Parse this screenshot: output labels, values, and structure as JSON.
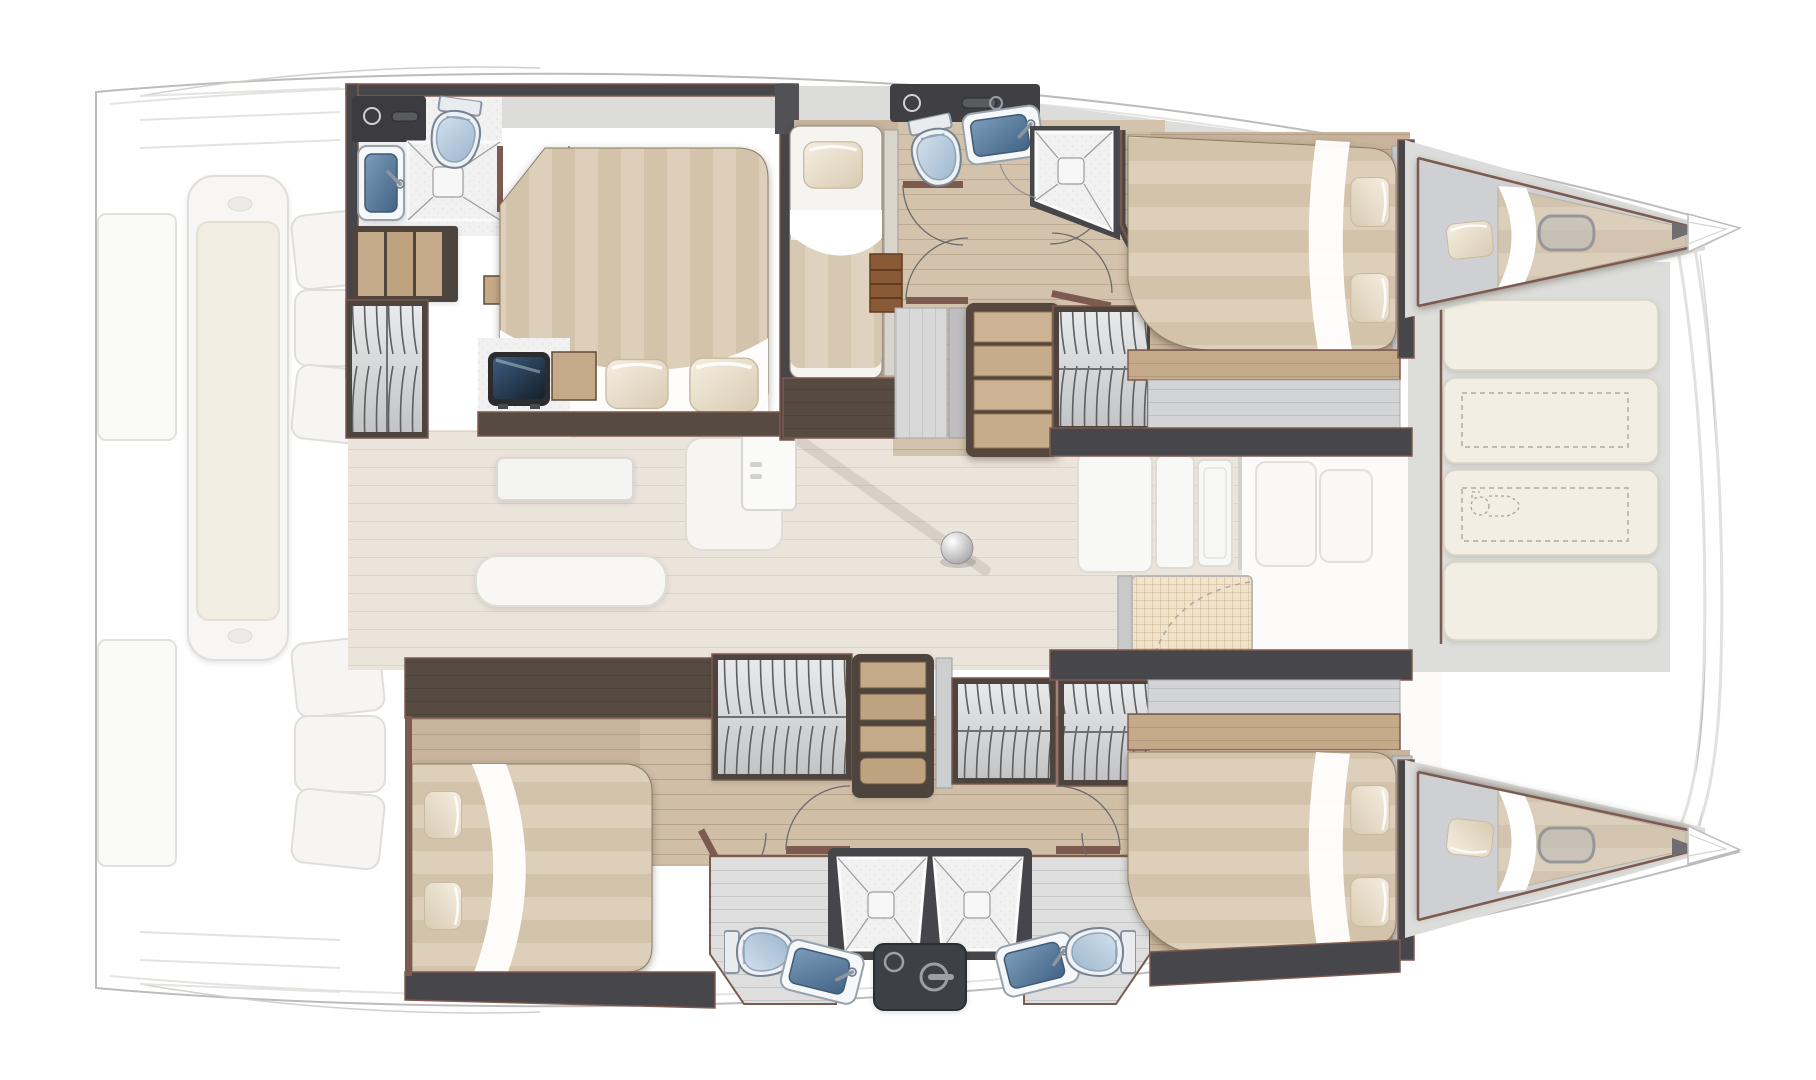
{
  "document": {
    "kind": "catamaran-interior-floor-plan",
    "view": "top-down",
    "orientation": "bow-right-stern-left",
    "canvas_px": {
      "w": 1816,
      "h": 1080
    },
    "visible_text": []
  },
  "palette": {
    "background": "#ffffff",
    "hull_outline": "#bcbcbc",
    "faded_deck_fill": "#f7f6f3",
    "faded_deck_stroke": "#dcdbd6",
    "saloon_floor": "#ebe4db",
    "cabin_wood_floor": "#c8b49c",
    "corridor_wood_floor": "#d3c2ac",
    "wall_dark_gray": "#47474b",
    "wall_dark_wood": "#564a41",
    "wall_trim_rosewood": "#7d5a50",
    "marble_deck": "#dcdcda",
    "tile_white": "#f1f1f1",
    "wardrobe_gray": "#d6d7d9",
    "bed_stripe_light": "#ddcfba",
    "bed_stripe_dark": "#d3c3ab",
    "sheet_white": "#ffffff",
    "pillow_ivory": "#ece1cf",
    "basin_blue": "#5d81a5",
    "toilet_lid_blue": "#b7cbdf",
    "tv_navy": "#243a52",
    "steps_wood": "#cdb394",
    "sunpad_cream": "#f2eee3",
    "dashed_optional": "#b1aca0",
    "dark_module": "#3e4145"
  },
  "areas": {
    "aft_cockpit": {
      "render": "faded",
      "items": [
        "center-lounge-seat-with-cushion",
        "curved-sofa-three-cushions-port",
        "curved-sofa-three-cushions-starboard",
        "transom-platform-port",
        "transom-platform-starboard",
        "swim-step-lines"
      ]
    },
    "saloon": {
      "render": "faded",
      "items": [
        "dining-table",
        "sofa",
        "chaise-seat",
        "saloon-door-with-handle",
        "galley-counter-slabs",
        "mast-foot-ball",
        "boom-shadow-line"
      ]
    },
    "front_cockpit": {
      "render": "faded",
      "items": [
        "woven-top-table",
        "bench-module-1",
        "bench-module-2",
        "door-swing-dashed-arc"
      ]
    },
    "foredeck": {
      "items": [
        "sunpad-cushion-1",
        "sunpad-cushion-2",
        "sunpad-cushion-3",
        "sunpad-cushion-4",
        "optional-storage-dashed-rect-1",
        "optional-storage-dashed-rect-2",
        "optional-toilet-dashed-outline",
        "bow-crossbeam",
        "bow-tip-port",
        "bow-tip-starboard"
      ]
    },
    "port_hull_top": {
      "rooms": [
        {
          "name": "aft-cabin",
          "items": [
            "double-bed",
            "pillows-x2",
            "hanging-wardrobe",
            "open-shelf-unit",
            "tv-screen",
            "wood-side-cabinet",
            "nightstand-box"
          ]
        },
        {
          "name": "aft-bathroom",
          "items": [
            "toilet",
            "washbasin-blue",
            "shower-tray-x-pattern",
            "dark-vanity-counter-with-faucet",
            "hinged-door"
          ]
        },
        {
          "name": "mid-guest-berth",
          "items": [
            "single-berth",
            "pillow",
            "storage-cabinet",
            "second-berth-edge"
          ]
        },
        {
          "name": "corridor",
          "items": [
            "staircase-4-treads",
            "hinged-door-x4",
            "gray-cabinets",
            "ladder-shelf",
            "hanging-wardrobe"
          ]
        },
        {
          "name": "fwd-bathroom",
          "items": [
            "toilet",
            "washbasin-blue",
            "shower-tray-x-pattern",
            "dark-vanity-counter-with-faucet"
          ]
        },
        {
          "name": "fwd-cabin",
          "items": [
            "double-bed",
            "pillows-x2",
            "wood-shelf-band",
            "gray-bench"
          ]
        },
        {
          "name": "forepeak-berth",
          "items": [
            "wedge-mattress",
            "pillow",
            "hull-portlight"
          ]
        }
      ]
    },
    "starboard_hull_bottom": {
      "rooms": [
        {
          "name": "aft-cabin",
          "items": [
            "double-bed",
            "pillows-x2"
          ]
        },
        {
          "name": "wardrobe-row",
          "items": [
            "hanging-wardrobe-x3",
            "open-shelf-column",
            "narrow-cabinet"
          ]
        },
        {
          "name": "corridor",
          "items": [
            "hinged-door-x5"
          ]
        },
        {
          "name": "aft-bathroom",
          "items": [
            "toilet",
            "washbasin-blue",
            "shower-tray-x-pattern"
          ]
        },
        {
          "name": "fwd-bathroom",
          "items": [
            "toilet",
            "washbasin-blue",
            "shower-tray-x-pattern"
          ]
        },
        {
          "name": "technical-module",
          "items": [
            "dark-panel-with-round-sink-and-lever"
          ]
        },
        {
          "name": "fwd-cabin",
          "items": [
            "double-bed",
            "pillows-x2",
            "wood-shelf-band",
            "gray-bench"
          ]
        },
        {
          "name": "forepeak-berth",
          "items": [
            "wedge-mattress",
            "pillow"
          ]
        }
      ]
    }
  },
  "fixture_counts": {
    "double_beds": 4,
    "single_berths": 3,
    "forepeak_berths": 2,
    "toilets": 4,
    "optional_dashed_toilets": 1,
    "washbasins": 4,
    "showers": 4,
    "hanging_wardrobes": 5,
    "staircases": 1,
    "hinged_doors": 10,
    "sunpads": 4
  }
}
